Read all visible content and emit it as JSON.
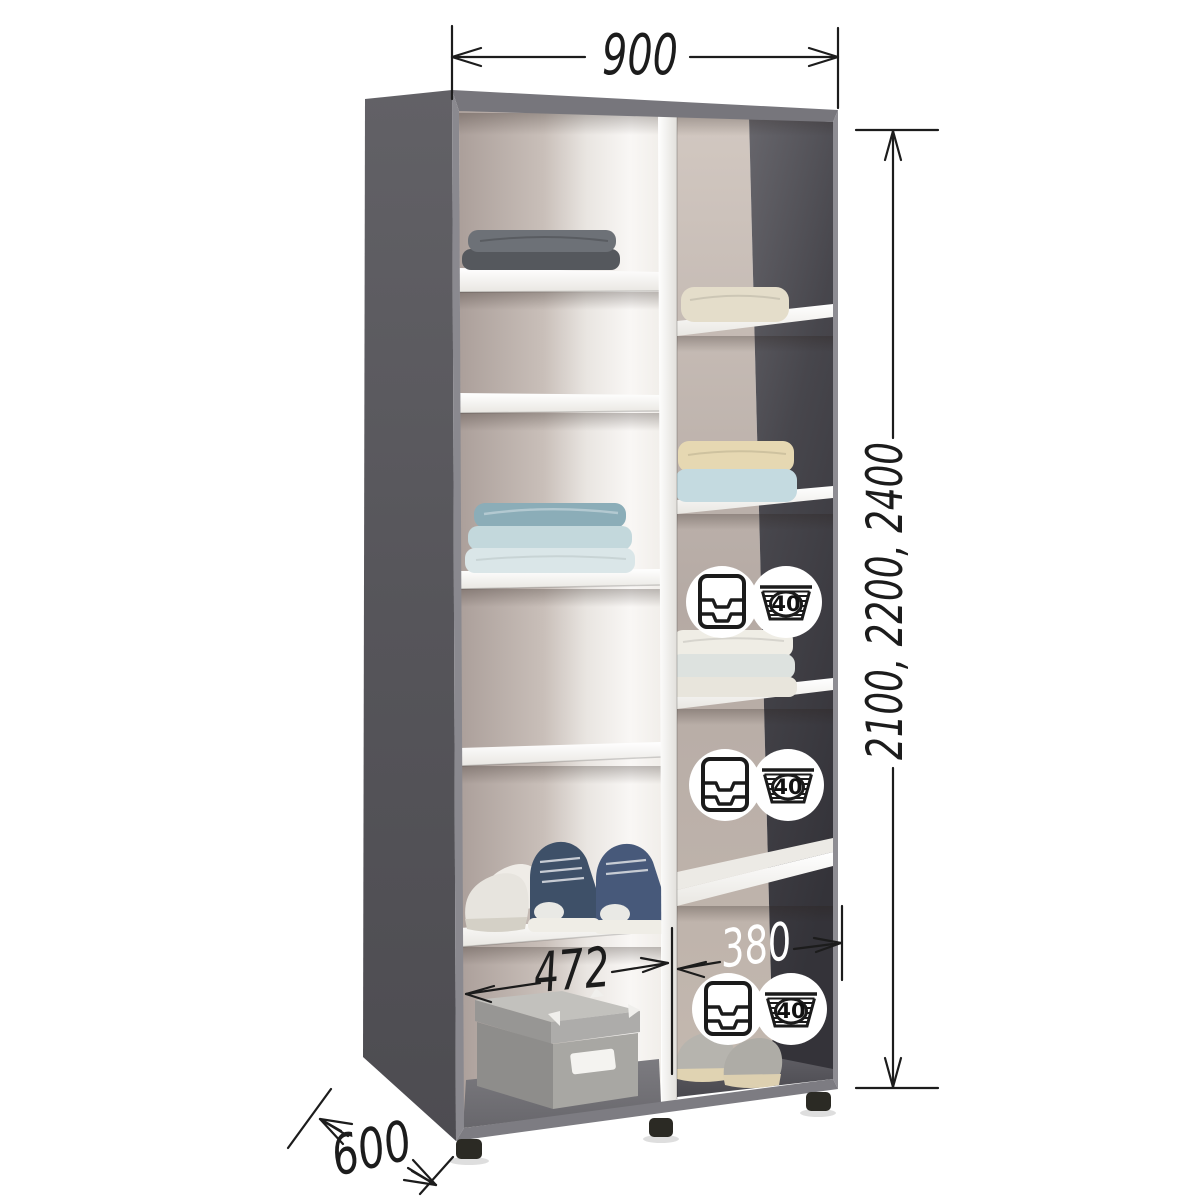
{
  "diagram": {
    "type": "furniture-dimension-diagram",
    "subject": "two-section wardrobe interior with shelves",
    "dimensions": {
      "overall_width_mm": "900",
      "overall_heights_mm": "2100, 2200, 2400",
      "overall_depth_mm": "600",
      "left_section_width_mm": "472",
      "right_section_width_mm": "380"
    },
    "care_icons": {
      "wash_temperature": "40",
      "drawer_icon": "drawer-organizer-icon",
      "basket_icon": "laundry-basket-40-icon",
      "pairs_count": 3
    },
    "items": [
      "folded-clothes-gray",
      "folded-clothes-teal",
      "folded-towel-cream",
      "folded-clothes-cream-blue",
      "folded-clothes-ivory",
      "white-sneakers",
      "navy-high-top-sneakers",
      "gray-sneakers",
      "storage-box"
    ],
    "colors": {
      "carcass_gray": "#59585d",
      "inner_dark_wall": "#3e3d43",
      "inner_beige_wall": "#b9aea8",
      "partition_white": "#f3f1ee",
      "shelf_white": "#fcfcfb",
      "dimension_line": "#1c1c1c",
      "background": "#ffffff"
    }
  }
}
